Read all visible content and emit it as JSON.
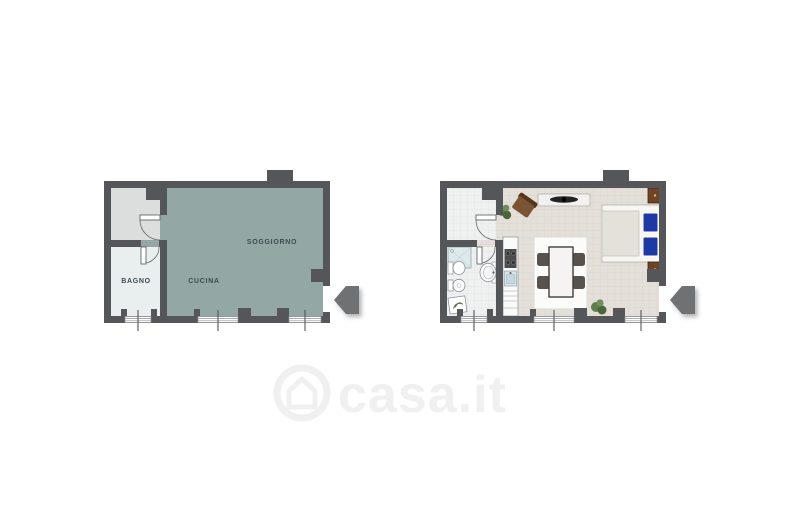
{
  "page": {
    "background": "#ffffff",
    "description": "real-estate listing floor plan image with schematic and furnished versions side by side"
  },
  "watermark": {
    "brand_text": "casa.it",
    "icon": "house-circle-logo",
    "color": "#f0f0f0"
  },
  "plans": {
    "schematic": {
      "name": "empty floor plan",
      "labels": {
        "bathroom": "BAGNO",
        "kitchen": "CUCINA",
        "living_room": "SOGGIORNO"
      },
      "features": [
        "entry-door-arrow",
        "three-windows",
        "two-interior-doors",
        "chimney-bump"
      ],
      "colors": {
        "walls": "#54565a",
        "main_room": "#93a8a4",
        "hall": "#dcdddd",
        "bathroom": "#e8efee",
        "label_text": "#3e4a52"
      }
    },
    "furnished": {
      "name": "furnished floor plan",
      "furniture": [
        "armchair",
        "plant",
        "tv-console",
        "tv",
        "double-bed",
        "blue-pillows",
        "nightstand-top",
        "nightstand-bottom",
        "kitchen-counter",
        "cooktop",
        "kitchen-sink",
        "dining-rug",
        "dining-table",
        "four-chairs",
        "floor-plant",
        "shower",
        "toilet",
        "bidet",
        "washbasin",
        "bath-corner-plant"
      ],
      "colors": {
        "floor_tile": "#e4e0d9",
        "wet_floor_tile": "#eff1f0",
        "walls": "#54565a",
        "wood": "#6f4426",
        "pillows": "#1d39a6",
        "plant": "#5f7c4b"
      }
    }
  }
}
